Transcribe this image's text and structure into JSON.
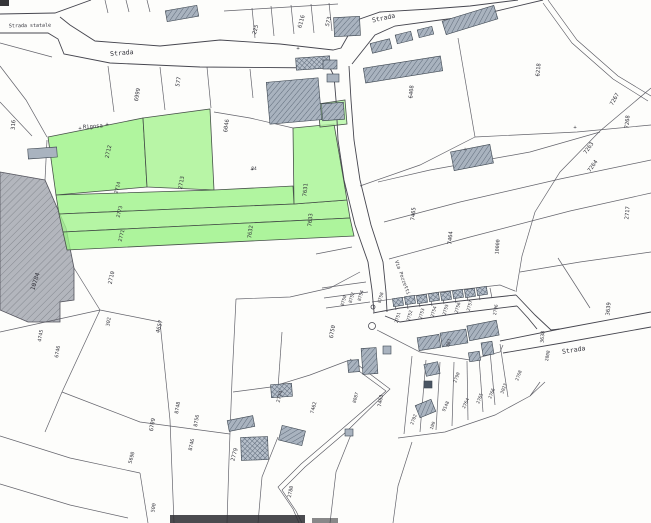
{
  "map": {
    "title": "Scanned cadastral parcel map with highlighted parcels",
    "colors": {
      "background": "#fdfdfb",
      "boundary": "#53535c",
      "road_edge": "#46464f",
      "green_stroke": "#47514a",
      "building_fill": "#a9b3bf",
      "building_hatch": "#5f6b7a",
      "building_dark": "#4a5563",
      "area_fill": "#b3b6bd",
      "area_hatch": "#84888f",
      "label_ink": "#33333b"
    },
    "road_labels": [
      {
        "t": "Strada statale",
        "x": 30,
        "y": 27,
        "r": -1,
        "s": 5
      },
      {
        "t": "Strada",
        "x": 122,
        "y": 55,
        "r": -5,
        "s": 6.5
      },
      {
        "t": "Strada",
        "x": 384,
        "y": 20,
        "r": -12,
        "s": 6.5
      },
      {
        "t": "Strada",
        "x": 574,
        "y": 352,
        "r": -9,
        "s": 6.5
      },
      {
        "t": "Via Pozzetti",
        "x": 401,
        "y": 278,
        "r": 70,
        "s": 5
      },
      {
        "t": "Rigosa",
        "x": 93,
        "y": 128,
        "r": -4,
        "s": 5.5
      }
    ],
    "marks": [
      {
        "t": "+",
        "x": 80,
        "y": 130
      },
      {
        "t": "+",
        "x": 107,
        "y": 126
      },
      {
        "t": "+",
        "x": 252,
        "y": 171
      },
      {
        "t": "+",
        "x": 298,
        "y": 50
      },
      {
        "t": "+",
        "x": 465,
        "y": 151
      },
      {
        "t": "+",
        "x": 575,
        "y": 129
      }
    ],
    "parcel_numbers": [
      {
        "t": "316",
        "x": 15,
        "y": 125,
        "r": -85
      },
      {
        "t": "6999",
        "x": 139,
        "y": 95,
        "r": -80
      },
      {
        "t": "577",
        "x": 180,
        "y": 82,
        "r": -80
      },
      {
        "t": "225",
        "x": 257,
        "y": 30,
        "r": -75
      },
      {
        "t": "6116",
        "x": 303,
        "y": 22,
        "r": -75
      },
      {
        "t": "573",
        "x": 330,
        "y": 22,
        "r": -75
      },
      {
        "t": "6408",
        "x": 413,
        "y": 92,
        "r": -85
      },
      {
        "t": "6046",
        "x": 228,
        "y": 126,
        "r": -82
      },
      {
        "t": "6218",
        "x": 540,
        "y": 70,
        "r": -85
      },
      {
        "t": "7267",
        "x": 616,
        "y": 100,
        "r": -60
      },
      {
        "t": "7268",
        "x": 629,
        "y": 122,
        "r": -85
      },
      {
        "t": "7263",
        "x": 590,
        "y": 149,
        "r": -55
      },
      {
        "t": "7264",
        "x": 594,
        "y": 167,
        "r": -55
      },
      {
        "t": "2717",
        "x": 629,
        "y": 213,
        "r": -85
      },
      {
        "t": "7465",
        "x": 415,
        "y": 214,
        "r": -85
      },
      {
        "t": "7464",
        "x": 452,
        "y": 238,
        "r": -85
      },
      {
        "t": "10000",
        "x": 499,
        "y": 247,
        "r": -85,
        "s": 5
      },
      {
        "t": "3639",
        "x": 610,
        "y": 309,
        "r": -85
      },
      {
        "t": "3638",
        "x": 544,
        "y": 337,
        "r": -85,
        "s": 5
      },
      {
        "t": "2808",
        "x": 549,
        "y": 356,
        "r": -80,
        "s": 4.5
      },
      {
        "t": "2796",
        "x": 497,
        "y": 310,
        "r": -80,
        "s": 4.5
      },
      {
        "t": "2712",
        "x": 110,
        "y": 152,
        "r": -78
      },
      {
        "t": "2713",
        "x": 183,
        "y": 183,
        "r": -80
      },
      {
        "t": "2714",
        "x": 119,
        "y": 188,
        "r": -76,
        "s": 5
      },
      {
        "t": "2773",
        "x": 121,
        "y": 212,
        "r": -76,
        "s": 5
      },
      {
        "t": "2771",
        "x": 123,
        "y": 236,
        "r": -76,
        "s": 5
      },
      {
        "t": "7631",
        "x": 307,
        "y": 190,
        "r": -85
      },
      {
        "t": "7632",
        "x": 252,
        "y": 232,
        "r": -82
      },
      {
        "t": "7633",
        "x": 312,
        "y": 220,
        "r": -85
      },
      {
        "t": "84",
        "x": 254,
        "y": 170,
        "r": 0,
        "s": 4.5
      },
      {
        "t": "10784",
        "x": 37,
        "y": 282,
        "r": -72,
        "s": 6
      },
      {
        "t": "2710",
        "x": 113,
        "y": 278,
        "r": -78
      },
      {
        "t": "302",
        "x": 110,
        "y": 322,
        "r": -80,
        "s": 5
      },
      {
        "t": "4657",
        "x": 161,
        "y": 327,
        "r": -75
      },
      {
        "t": "4745",
        "x": 42,
        "y": 336,
        "r": -80,
        "s": 5
      },
      {
        "t": "6746",
        "x": 59,
        "y": 352,
        "r": -80,
        "s": 5
      },
      {
        "t": "6709",
        "x": 154,
        "y": 425,
        "r": -80
      },
      {
        "t": "5690",
        "x": 133,
        "y": 458,
        "r": -75,
        "s": 5
      },
      {
        "t": "500",
        "x": 155,
        "y": 508,
        "r": -80,
        "s": 5
      },
      {
        "t": "8748",
        "x": 179,
        "y": 408,
        "r": -80,
        "s": 5
      },
      {
        "t": "8756",
        "x": 198,
        "y": 421,
        "r": -80,
        "s": 5
      },
      {
        "t": "8746",
        "x": 193,
        "y": 445,
        "r": -78,
        "s": 5
      },
      {
        "t": "6750",
        "x": 334,
        "y": 332,
        "r": -80
      },
      {
        "t": "8750",
        "x": 345,
        "y": 301,
        "r": -75,
        "s": 4.5
      },
      {
        "t": "8752",
        "x": 353,
        "y": 298,
        "r": -75,
        "s": 4.5
      },
      {
        "t": "8754",
        "x": 362,
        "y": 296,
        "r": -75,
        "s": 4.5
      },
      {
        "t": "8758",
        "x": 382,
        "y": 298,
        "r": -75,
        "s": 4.5
      },
      {
        "t": "2751",
        "x": 399,
        "y": 318,
        "r": -75,
        "s": 4.5
      },
      {
        "t": "2752",
        "x": 411,
        "y": 316,
        "r": -75,
        "s": 4.5
      },
      {
        "t": "2753",
        "x": 423,
        "y": 314,
        "r": -75,
        "s": 4.5
      },
      {
        "t": "2754",
        "x": 435,
        "y": 312,
        "r": -75,
        "s": 4.5
      },
      {
        "t": "2755",
        "x": 447,
        "y": 310,
        "r": -75,
        "s": 4.5
      },
      {
        "t": "2756",
        "x": 459,
        "y": 308,
        "r": -75,
        "s": 4.5
      },
      {
        "t": "2757",
        "x": 471,
        "y": 306,
        "r": -75,
        "s": 4.5
      },
      {
        "t": "861",
        "x": 450,
        "y": 343,
        "r": -75,
        "s": 4.5
      },
      {
        "t": "2779",
        "x": 236,
        "y": 455,
        "r": -75
      },
      {
        "t": "7462",
        "x": 315,
        "y": 408,
        "r": -75,
        "s": 5
      },
      {
        "t": "7463",
        "x": 382,
        "y": 401,
        "r": -80,
        "s": 5
      },
      {
        "t": "8087",
        "x": 357,
        "y": 398,
        "r": -75,
        "s": 4.5
      },
      {
        "t": "2774",
        "x": 281,
        "y": 397,
        "r": -75,
        "s": 5
      },
      {
        "t": "2780",
        "x": 292,
        "y": 492,
        "r": -78,
        "s": 5
      },
      {
        "t": "9148",
        "x": 447,
        "y": 407,
        "r": -65,
        "s": 4.5
      },
      {
        "t": "2764",
        "x": 467,
        "y": 404,
        "r": -65,
        "s": 4.5
      },
      {
        "t": "2765",
        "x": 481,
        "y": 399,
        "r": -68,
        "s": 4.5
      },
      {
        "t": "2766",
        "x": 493,
        "y": 394,
        "r": -68,
        "s": 4.5
      },
      {
        "t": "3023",
        "x": 505,
        "y": 389,
        "r": -70,
        "s": 4.5
      },
      {
        "t": "2768",
        "x": 520,
        "y": 376,
        "r": -70,
        "s": 4.5
      },
      {
        "t": "2790",
        "x": 458,
        "y": 378,
        "r": -70,
        "s": 4.5
      },
      {
        "t": "2702",
        "x": 415,
        "y": 420,
        "r": -70,
        "s": 4.5
      },
      {
        "t": "109",
        "x": 434,
        "y": 426,
        "r": -70,
        "s": 4.5
      }
    ],
    "green_parcels": [
      {
        "id": "2712",
        "points": "48,137 143,118 147,187 56,195",
        "fill": "#9cf287"
      },
      {
        "id": "2713",
        "points": "143,118 210,109 214,190 147,187",
        "fill": "#a6f391"
      },
      {
        "id": "2714",
        "points": "56,195 214,190 293,186 294,204 59,214",
        "fill": "#9ef28a"
      },
      {
        "id": "2773",
        "points": "59,214 294,204 347,200 350,218 63,232",
        "fill": "#a2f38e"
      },
      {
        "id": "2771",
        "points": "63,232 350,218 354,236 67,250",
        "fill": "#98f184"
      },
      {
        "id": "7631",
        "points": "293,128 334,124 344,182 347,200 294,204",
        "fill": "#a5f492"
      },
      {
        "id": "small",
        "points": "318,104 345,100 347,124 320,127",
        "fill": "#b4f6a4"
      }
    ],
    "hatched_area": {
      "points": "0,172 45,180 66,228 74,268 74,300 60,302 60,322 28,322 0,310"
    },
    "road_edges": [
      "0,14 55,13 91,0",
      "60,17 70,25 95,41 160,46 220,40 280,44 333,50 341,48 357,20 380,12 430,9 470,6 518,0",
      "0,33 48,33 58,39 64,54 110,63 200,67 330,68 334,76 336,100 338,140 344,180 355,225 368,262 372,290 374,312",
      "352,64 375,35 395,26 440,20 480,15 543,0",
      "349,66 351,100 354,140 360,180 371,225 383,262 386,292 387,312",
      "373,313 400,308 460,301 516,295",
      "385,316 400,322 460,313 517,306",
      "516,295 535,315 551,330 560,329",
      "517,306 528,318 537,329",
      "500,341 560,329 651,312",
      "503,353 562,343 651,327"
    ],
    "tracks": [
      "348,363 386,391 342,429 301,464 278,487 293,509 299,523",
      "350,359 390,389 346,432 305,467 282,490 296,511 302,523",
      "548,0 577,40 618,76 651,96",
      "543,3 572,43 613,79 648,101"
    ],
    "boundaries": [
      "0,43 52,57",
      "0,66 26,100 47,137",
      "0,102 32,136",
      "47,140 45,180",
      "105,0 108,13",
      "126,0 129,12",
      "147,0 150,12",
      "224,11 338,4",
      "252,8 255,38",
      "271,6 274,36",
      "291,5 294,34",
      "311,4 314,33",
      "329,3 332,31",
      "108,66 114,112",
      "160,67 165,110",
      "207,67 211,108",
      "250,69 253,98",
      "214,112 250,118 293,128",
      "458,38 475,137",
      "475,137 577,132 651,125",
      "360,186 420,165 475,137",
      "378,182 430,170 530,152 600,132",
      "384,222 460,202 560,179 651,160",
      "389,259 470,237 570,211 651,193",
      "651,88 600,131 560,172 535,212 522,256 516,292",
      "520,272 580,262 651,252",
      "558,258 576,286 590,308",
      "74,268 100,310",
      "100,310 0,332",
      "100,310 160,322",
      "160,322 170,420 174,523",
      "100,310 62,392 45,432",
      "62,392 140,422 230,434",
      "0,436 70,458 140,473",
      "140,473 148,523",
      "0,484 70,505 128,518",
      "236,299 232,380 229,460 227,523",
      "360,272 330,288 290,297 236,299",
      "282,332 278,388",
      "347,361 310,375 271,387 233,392",
      "278,437 262,477 258,523",
      "352,432 336,472 330,523",
      "412,442 398,486 393,523",
      "372,302 440,292 500,285 515,291",
      "394,300 396,310",
      "406,298 408,309",
      "418,297 420,307",
      "430,295 432,306",
      "442,294 444,304",
      "454,292 456,303",
      "466,291 468,301",
      "478,289 480,300",
      "490,288 492,298",
      "377,330 420,352 470,360 500,352 503,345",
      "398,438 445,432 495,415 530,396 545,382",
      "412,356 404,434",
      "426,360 420,432",
      "440,362 436,430",
      "454,362 452,426",
      "467,361 468,420",
      "479,357 483,412",
      "490,351 495,405",
      "500,344 508,397",
      "540,382 530,396",
      "316,254 352,247",
      "322,288 366,282",
      "324,298 368,292",
      "326,308 370,302"
    ],
    "buildings": [
      {
        "x": 166,
        "y": 8,
        "w": 32,
        "h": 11,
        "r": -10,
        "st": "h"
      },
      {
        "x": 334,
        "y": 17,
        "w": 26,
        "h": 19,
        "r": -3,
        "st": "h"
      },
      {
        "x": 371,
        "y": 41,
        "w": 20,
        "h": 10,
        "r": -14,
        "st": "h"
      },
      {
        "x": 396,
        "y": 33,
        "w": 16,
        "h": 9,
        "r": -14,
        "st": "h"
      },
      {
        "x": 418,
        "y": 28,
        "w": 15,
        "h": 8,
        "r": -14,
        "st": "h"
      },
      {
        "x": 364,
        "y": 62,
        "w": 78,
        "h": 15,
        "r": -9,
        "st": "h"
      },
      {
        "x": 443,
        "y": 13,
        "w": 54,
        "h": 14,
        "r": -17,
        "st": "h"
      },
      {
        "x": 296,
        "y": 57,
        "w": 34,
        "h": 12,
        "r": -4,
        "st": "g"
      },
      {
        "x": 268,
        "y": 80,
        "w": 52,
        "h": 42,
        "r": -5,
        "st": "h"
      },
      {
        "x": 323,
        "y": 60,
        "w": 14,
        "h": 9,
        "r": 0,
        "st": "h"
      },
      {
        "x": 327,
        "y": 74,
        "w": 12,
        "h": 8,
        "r": 0,
        "st": "p"
      },
      {
        "x": 322,
        "y": 103,
        "w": 22,
        "h": 17,
        "r": -4,
        "st": "h"
      },
      {
        "x": 452,
        "y": 148,
        "w": 40,
        "h": 19,
        "r": -11,
        "st": "h"
      },
      {
        "x": 28,
        "y": 148,
        "w": 29,
        "h": 10,
        "r": -4,
        "st": "p"
      },
      {
        "x": 393,
        "y": 298,
        "w": 10,
        "h": 8,
        "r": -8,
        "st": "g"
      },
      {
        "x": 405,
        "y": 296,
        "w": 10,
        "h": 8,
        "r": -8,
        "st": "g"
      },
      {
        "x": 417,
        "y": 295,
        "w": 10,
        "h": 8,
        "r": -8,
        "st": "g"
      },
      {
        "x": 429,
        "y": 293,
        "w": 10,
        "h": 8,
        "r": -8,
        "st": "g"
      },
      {
        "x": 441,
        "y": 292,
        "w": 10,
        "h": 8,
        "r": -8,
        "st": "g"
      },
      {
        "x": 453,
        "y": 290,
        "w": 10,
        "h": 8,
        "r": -8,
        "st": "g"
      },
      {
        "x": 465,
        "y": 289,
        "w": 10,
        "h": 8,
        "r": -8,
        "st": "g"
      },
      {
        "x": 477,
        "y": 287,
        "w": 10,
        "h": 8,
        "r": -8,
        "st": "g"
      },
      {
        "x": 418,
        "y": 336,
        "w": 22,
        "h": 13,
        "r": -9,
        "st": "h"
      },
      {
        "x": 441,
        "y": 331,
        "w": 26,
        "h": 14,
        "r": -9,
        "st": "h"
      },
      {
        "x": 468,
        "y": 323,
        "w": 30,
        "h": 15,
        "r": -11,
        "st": "h"
      },
      {
        "x": 482,
        "y": 342,
        "w": 11,
        "h": 13,
        "r": -9,
        "st": "h"
      },
      {
        "x": 469,
        "y": 352,
        "w": 11,
        "h": 9,
        "r": -9,
        "st": "h"
      },
      {
        "x": 362,
        "y": 348,
        "w": 15,
        "h": 26,
        "r": -4,
        "st": "h"
      },
      {
        "x": 348,
        "y": 360,
        "w": 11,
        "h": 12,
        "r": -4,
        "st": "h"
      },
      {
        "x": 383,
        "y": 346,
        "w": 8,
        "h": 8,
        "r": 0,
        "st": "p"
      },
      {
        "x": 425,
        "y": 363,
        "w": 14,
        "h": 12,
        "r": -12,
        "st": "h"
      },
      {
        "x": 424,
        "y": 381,
        "w": 8,
        "h": 7,
        "r": 0,
        "st": "d"
      },
      {
        "x": 271,
        "y": 384,
        "w": 21,
        "h": 13,
        "r": -4,
        "st": "g"
      },
      {
        "x": 228,
        "y": 418,
        "w": 26,
        "h": 11,
        "r": -11,
        "st": "h"
      },
      {
        "x": 241,
        "y": 437,
        "w": 27,
        "h": 23,
        "r": -2,
        "st": "g"
      },
      {
        "x": 280,
        "y": 428,
        "w": 24,
        "h": 15,
        "r": 14,
        "st": "h"
      },
      {
        "x": 417,
        "y": 402,
        "w": 17,
        "h": 13,
        "r": -22,
        "st": "h"
      },
      {
        "x": 345,
        "y": 429,
        "w": 8,
        "h": 7,
        "r": 0,
        "st": "p"
      }
    ],
    "circles": [
      {
        "x": 372,
        "y": 326,
        "r": 3.5
      },
      {
        "x": 373,
        "y": 307,
        "r": 2
      }
    ],
    "smudges": [
      {
        "x": 170,
        "y": 515,
        "w": 135,
        "h": 8,
        "f": "#2c2c30",
        "o": 0.85
      },
      {
        "x": 312,
        "y": 518,
        "w": 26,
        "h": 5,
        "f": "#3a3a3e",
        "o": 0.6
      },
      {
        "x": 0,
        "y": 0,
        "w": 9,
        "h": 6,
        "f": "#1f1f22",
        "o": 0.9
      }
    ]
  }
}
